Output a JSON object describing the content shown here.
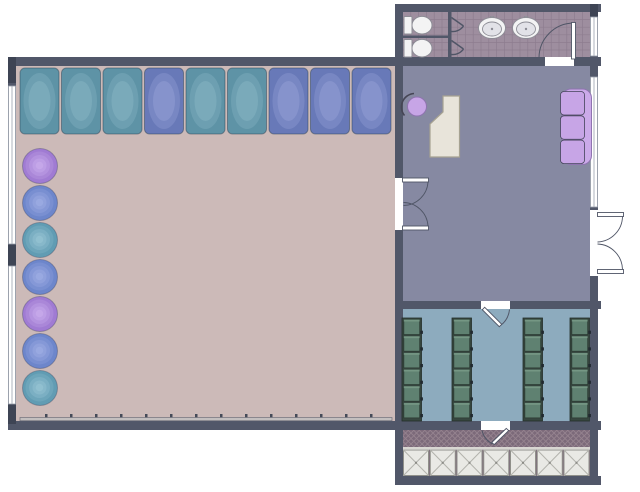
{
  "canvas": {
    "width": 640,
    "height": 492,
    "background": "#ffffff"
  },
  "palette": {
    "wall": "#515769",
    "wall_dark": "#3e4454",
    "studio_floor": "#ccbab8",
    "office_floor": "#8689a2",
    "restroom_floor": "#9e8e9f",
    "restroom_grid": "#8d7d8f",
    "locker_floor": "#8dabbe",
    "vestibule_floor": "#7c6a7a",
    "vestibule_lattice": "#95838f",
    "window_white": "#ffffff",
    "window_frame": "#9aa0ac",
    "door_stroke": "#4f5566",
    "desk_fill": "#e8e4da",
    "desk_stroke": "#a6a292",
    "furniture_purple": "#c7a5e6",
    "furniture_purple_dark": "#8f74b0",
    "cushion_stroke": "#44445a",
    "fixture_white": "#f3f3f4",
    "fixture_stroke": "#8d8d96",
    "fixture_inner": "#e2e2e8",
    "mirror_bar": "#c3bfbf",
    "mirror_tick": "#454a58",
    "locker_frame": "#374740",
    "locker_cell": "#5f8171",
    "locker_cell_light": "#7b9c8a",
    "locker_cell_stroke": "#2c3b34",
    "locker_handle": "#20282f",
    "square_fill": "#e9e9e5",
    "square_stroke": "#90908a",
    "square_cross": "#b3b3ad",
    "entry_divider": "#d8d6d2",
    "mat_teal": [
      "#8ab7c5",
      "#5e93a6"
    ],
    "mat_purple": [
      "#97a2d6",
      "#6879b8"
    ],
    "ball_purple": [
      "#cdb0ee",
      "#a07bd3"
    ],
    "ball_blue": [
      "#a2b1e6",
      "#6d86cb"
    ],
    "ball_teal": [
      "#9cc8d6",
      "#619cb3"
    ]
  },
  "studio": {
    "mats": {
      "count": 9,
      "x_start": 20,
      "y": 68,
      "width": 39,
      "height": 66,
      "pitch": 41.5,
      "colors": [
        "teal",
        "teal",
        "teal",
        "purple",
        "teal",
        "teal",
        "purple",
        "purple",
        "purple"
      ]
    },
    "balls": {
      "count": 7,
      "cx": 40,
      "r": 17.5,
      "cy_start": 166,
      "pitch": 37,
      "colors": [
        "purple",
        "blue",
        "teal",
        "blue",
        "purple",
        "blue",
        "teal"
      ]
    },
    "mirror": {
      "x": 20,
      "y": 417.5,
      "length": 372,
      "thickness": 3.2,
      "tick_count": 14,
      "tick_start": 45,
      "tick_pitch": 25
    }
  },
  "restroom": {
    "toilet_count": 2,
    "sink_count": 2,
    "stall_count": 2,
    "grid": {
      "cell_w": 7.8,
      "cell_h": 7.6
    }
  },
  "locker_room": {
    "columns": {
      "xs": [
        402,
        452,
        523,
        570
      ],
      "width": 19.5,
      "y_top": 318,
      "height": 103,
      "cells": 6
    }
  },
  "vestibule": {
    "lattice_spacing": 5.5
  },
  "entry_squares": {
    "count": 7,
    "x_start": 403.5,
    "y": 450,
    "size": 25,
    "pitch": 26.75,
    "height": 25.5
  }
}
